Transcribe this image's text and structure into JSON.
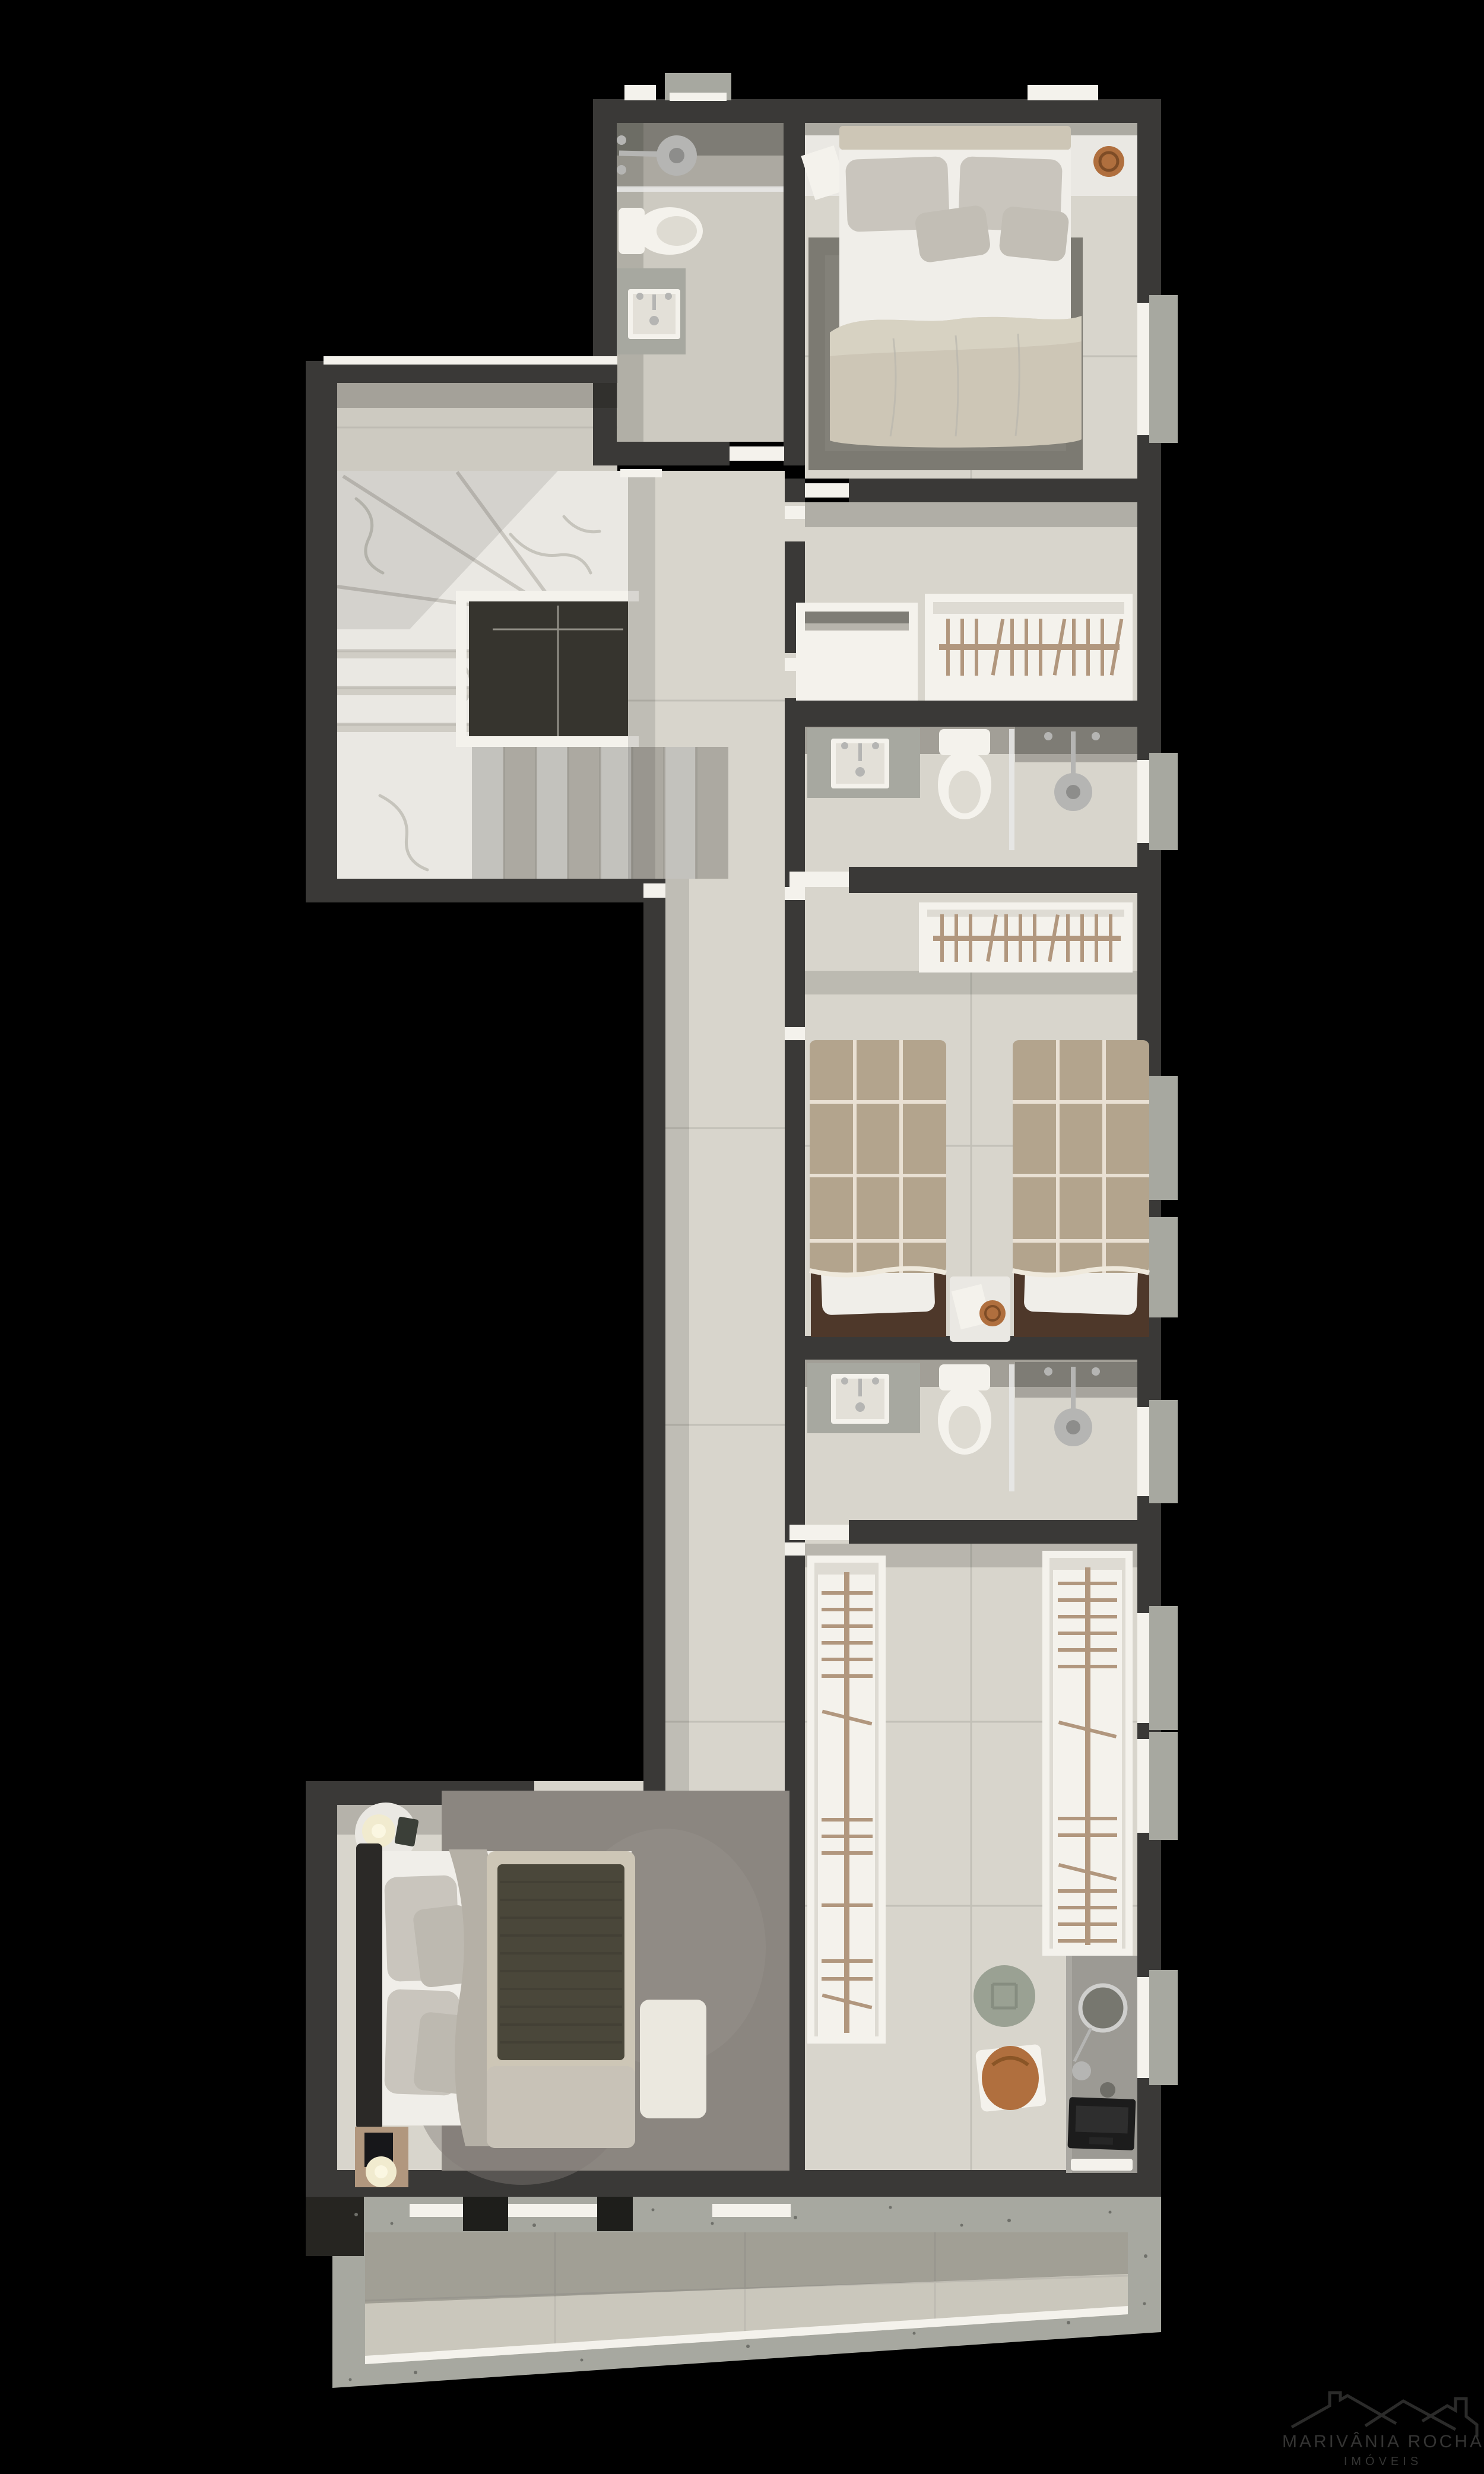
{
  "watermark": {
    "line1": "MARIVÂNIA ROCHA",
    "line2": "IMÓVEIS"
  },
  "palette": {
    "bg": "#000000",
    "wall": "#3a3937",
    "wallDark": "#262521",
    "floor": "#d8d5cc",
    "floorDim": "#cdcac1",
    "marble": "#eae8e3",
    "vein": "#bdbab2",
    "grout": "#b9b6ae",
    "white": "#f4f2ec",
    "tan": "#b1977e",
    "wood": "#4e382a",
    "plaid": "#b3a48d",
    "plaidLine": "#eee7da",
    "duvet": "#cdc6b6",
    "sheet": "#f0eee9",
    "pillow": "#c9c5bd",
    "rugTop": "#7c7a72",
    "rugMaster": "#8b8680",
    "olive": "#4a473a",
    "bench": "#ebe8df",
    "desk": "#9c9a94",
    "terrazzo": "#a7a8a0",
    "terraceTile": "#cac7bc",
    "copper": "#b06f3e",
    "lamp": "#f1ebcf",
    "chrome": "#b5b5b3",
    "voidDark": "#36342e",
    "glass": "#e9e9e7",
    "logo": "#2b2b2a",
    "logoText": "#343433"
  },
  "floorplan": {
    "type": "residential-upper-floor-plan-render",
    "rooms": [
      {
        "id": "bathroom-top",
        "furniture": [
          "shower",
          "toilet",
          "sink-counter"
        ]
      },
      {
        "id": "bedroom-top",
        "furniture": [
          "double-bed",
          "nightstand-left",
          "nightstand-right",
          "rug"
        ]
      },
      {
        "id": "stair-hall",
        "furniture": [
          "marble-staircase",
          "stairwell-void",
          "railing"
        ]
      },
      {
        "id": "dressing-nook",
        "furniture": [
          "open-shelf-unit",
          "clothes-rail"
        ]
      },
      {
        "id": "bathroom-middle",
        "furniture": [
          "sink-counter",
          "toilet",
          "shower"
        ]
      },
      {
        "id": "twin-bedroom",
        "furniture": [
          "single-bed-left",
          "single-bed-right",
          "shared-nightstand",
          "clothes-rail"
        ]
      },
      {
        "id": "bathroom-lower",
        "furniture": [
          "sink-counter",
          "toilet",
          "shower"
        ]
      },
      {
        "id": "walk-in-closet",
        "furniture": [
          "wardrobe-island-left",
          "wardrobe-island-right",
          "vanity-desk",
          "round-mirror",
          "laptop",
          "notebook",
          "pouf",
          "leather-bag"
        ]
      },
      {
        "id": "master-bedroom",
        "furniture": [
          "king-bed",
          "foot-bench",
          "area-rug",
          "round-side-table",
          "wood-nightstand",
          "table-lamp",
          "table-lamp"
        ]
      },
      {
        "id": "terrace",
        "furniture": []
      }
    ]
  }
}
